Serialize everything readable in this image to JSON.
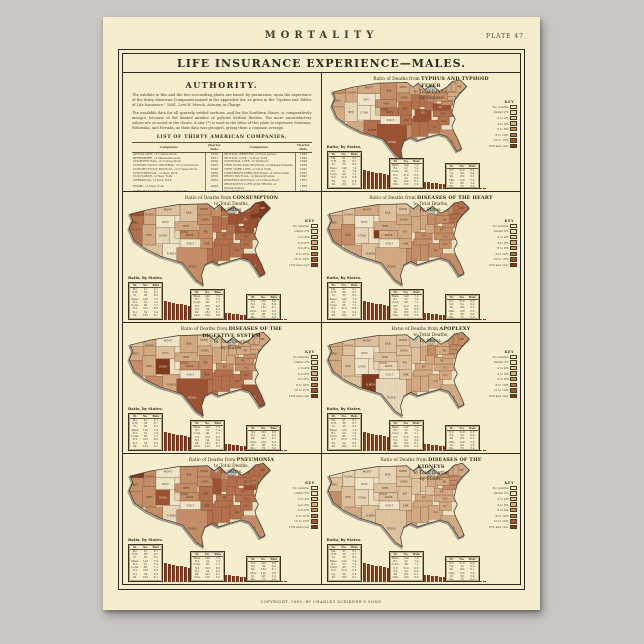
{
  "background_color": "#c9c6c4",
  "poster": {
    "bg": "#f4eecf"
  },
  "header": {
    "title": "MORTALITY",
    "plate": "PLATE 47"
  },
  "banner": {
    "title": "LIFE INSURANCE EXPERIENCE—MALES."
  },
  "authority": {
    "heading": "AUTHORITY.",
    "paragraphs": [
      "The exhibits in this and the two succeeding plates are based, by permission, upon the experience of the thirty American Companies named in the appended list, as given in the \"System and Tables of Life Insurance,\" 1881, Levi W. Meech, Actuary in Charge.",
      "The available data for all sparsely settled sections, and for the Southern States, is comparatively meagre, because of the limited number of policies written therein. The more unsatisfactory values are so noted in the charts. A star (*) is used in the titles of this plate to represent Montana, Nebraska, and Nevada, as their data was grouped, giving them a common average."
    ],
    "list_title": "LIST OF THIRTY AMERICAN COMPANIES.",
    "table_headers": [
      "Companies",
      "Charter Date",
      "Companies",
      "Charter Date"
    ],
    "companies_left": [
      [
        "AETNA LIFE, of Connecticut",
        "1850"
      ],
      [
        "BERKSHIRE, of Massachusetts",
        "1851"
      ],
      [
        "CHARTER OAK, of Connecticut",
        "1850"
      ],
      [
        "CONNECTICUT GENERAL, of Connecticut",
        "1865"
      ],
      [
        "CONNECTICUT MUTUAL, of Connecticut",
        "1846"
      ],
      [
        "CONTINENTAL, of New York",
        "1866"
      ],
      [
        "EQUITABLE, of New York",
        "1859"
      ],
      [
        "GERMANIA, of New York",
        "1860"
      ],
      [
        "HOME, of New York",
        "1860"
      ],
      [
        "JOHN HANCOCK, of Massachusetts",
        "1862"
      ],
      [
        "LIFE ASSOCIATION, of Missouri",
        "1868"
      ],
      [
        "MANHATTAN, of New York",
        "1850"
      ],
      [
        "MASSACHUSETTS HOSPITAL, of Massachusetts",
        "1823"
      ],
      [
        "MASSACHUSETTS MUTUAL, of Massachusetts",
        "1851"
      ],
      [
        "METROPOLITAN, of New York",
        "1866"
      ]
    ],
    "companies_right": [
      [
        "MUTUAL BENEFIT, of New Jersey",
        "1845"
      ],
      [
        "MUTUAL LIFE, of New York",
        "1842"
      ],
      [
        "NATIONAL LIFE, of Vermont",
        "1848"
      ],
      [
        "NEW ENGLAND MUTUAL, of Massachusetts",
        "1835"
      ],
      [
        "NEW YORK LIFE, of New York",
        "1841"
      ],
      [
        "NORTHWESTERN MUTUAL, of Wisconsin",
        "1857"
      ],
      [
        "PENN MUTUAL, of Pennsylvania",
        "1847"
      ],
      [
        "PHOENIX MUTUAL, of Connecticut",
        "1851"
      ],
      [
        "PROVIDENT LIFE AND TRUST, of Pennsylvania",
        "1865"
      ],
      [
        "ST. LOUIS MUTUAL, of Missouri",
        "1857"
      ],
      [
        "TRAVELERS, of Connecticut",
        "1863"
      ],
      [
        "UNION CENTRAL, of Ohio",
        "1867"
      ],
      [
        "UNION MUTUAL, of Maine",
        "1848"
      ],
      [
        "UNITED STATES, of New York",
        "1850"
      ],
      [
        "WASHINGTON, of New York",
        "1860"
      ]
    ]
  },
  "footer": {
    "caption": "COPYRIGHT, 1883, BY CHARLES SCRIBNER'S SONS."
  },
  "palette": [
    "#f2ebcf",
    "#eadbbc",
    "#e0c6a2",
    "#d4ad87",
    "#c5906a",
    "#b4724f",
    "#9d5334",
    "#7f3a1d"
  ],
  "key": {
    "header": "KEY",
    "labels": [
      "No returns",
      "Under 2%",
      "2 to 4%",
      "4 to 6%",
      "6 to 8%",
      "8 to 10%",
      "10 to 15%",
      "15% and over"
    ]
  },
  "map_title": {
    "prefix": "Ratio of Deaths from",
    "mid": "to Total Deaths,",
    "suffix": "by States."
  },
  "legend_label": "Ratio, by States.",
  "mini_table": {
    "headers": [
      "St.",
      "No.",
      "Rate"
    ],
    "rows": [
      [
        "Me.",
        "41",
        "9.1"
      ],
      [
        "N.H.",
        "38",
        "8.7"
      ],
      [
        "Vt.",
        "36",
        "8.2"
      ],
      [
        "Mass.",
        "140",
        "7.9"
      ],
      [
        "R.I.",
        "22",
        "7.4"
      ],
      [
        "Conn.",
        "96",
        "7.1"
      ],
      [
        "N.Y.",
        "310",
        "6.8"
      ],
      [
        "N.J.",
        "54",
        "6.4"
      ],
      [
        "Pa.",
        "182",
        "6.1"
      ],
      [
        "Ohio",
        "120",
        "5.8"
      ],
      [
        "Ill.",
        "98",
        "5.4"
      ],
      [
        "Mo.",
        "72",
        "5.0"
      ]
    ]
  },
  "legend_bars": [
    16.2,
    15.1,
    14.2,
    13.4,
    12.7,
    12.0,
    11.4,
    10.8,
    10.2,
    9.7,
    9.2,
    8.7,
    8.2,
    7.8,
    7.3,
    6.9,
    6.5,
    6.1,
    5.7,
    5.4,
    5.0,
    4.7,
    4.3,
    4.0,
    3.7,
    3.4,
    3.1,
    2.8,
    2.6,
    2.3,
    2.1,
    1.8,
    1.6,
    1.4,
    1.2,
    1.0,
    0.8,
    0.7,
    0.5,
    0.4
  ],
  "map_outline": "M6,16 L30,10 L62,5 L96,4 L104,10 L110,5 L118,13 L126,7 L136,15 L146,9 L152,3 L161,1 L169,9 L161,17 L155,25 L153,33 L151,41 L155,49 L151,57 L153,63 L159,75 L163,85 L157,88 L151,78 L145,70 L135,67 L121,71 L109,75 L101,71 L93,75 L89,87 L91,98 L83,93 L75,83 L67,73 L55,69 L41,65 L25,57 L11,47 L5,33 L9,23 Z",
  "lakes": [
    [
      106,
      7,
      2.5,
      5
    ],
    [
      124,
      12,
      6,
      3
    ],
    [
      115,
      4,
      6,
      2.5
    ]
  ],
  "states": [
    {
      "abbr": "WASH",
      "x": 2,
      "y": 5,
      "w": 20,
      "h": 13
    },
    {
      "abbr": "OREG",
      "x": 0,
      "y": 18,
      "w": 22,
      "h": 16
    },
    {
      "abbr": "CAL",
      "x": 0,
      "y": 34,
      "w": 20,
      "h": 34
    },
    {
      "abbr": "NEV",
      "x": 20,
      "y": 28,
      "w": 16,
      "h": 24
    },
    {
      "abbr": "IDAHO",
      "x": 22,
      "y": 5,
      "w": 14,
      "h": 23
    },
    {
      "abbr": "MONT",
      "x": 36,
      "y": 3,
      "w": 28,
      "h": 15
    },
    {
      "abbr": "WYO",
      "x": 36,
      "y": 18,
      "w": 22,
      "h": 14
    },
    {
      "abbr": "UTAH",
      "x": 36,
      "y": 32,
      "w": 16,
      "h": 18
    },
    {
      "abbr": "ARIZ",
      "x": 24,
      "y": 52,
      "w": 20,
      "h": 22
    },
    {
      "abbr": "COLO",
      "x": 58,
      "y": 30,
      "w": 22,
      "h": 14
    },
    {
      "abbr": "N.MEX",
      "x": 44,
      "y": 50,
      "w": 20,
      "h": 24
    },
    {
      "abbr": "DAK",
      "x": 64,
      "y": 3,
      "w": 20,
      "h": 22
    },
    {
      "abbr": "NEB",
      "x": 58,
      "y": 25,
      "w": 26,
      "h": 10
    },
    {
      "abbr": "KANS",
      "x": 64,
      "y": 35,
      "w": 22,
      "h": 10
    },
    {
      "abbr": "IND.T",
      "x": 64,
      "y": 45,
      "w": 24,
      "h": 10
    },
    {
      "abbr": "TEXAS",
      "x": 60,
      "y": 55,
      "w": 36,
      "h": 44
    },
    {
      "abbr": "MINN",
      "x": 84,
      "y": 3,
      "w": 16,
      "h": 14
    },
    {
      "abbr": "IOWA",
      "x": 84,
      "y": 17,
      "w": 18,
      "h": 11
    },
    {
      "abbr": "MO",
      "x": 86,
      "y": 28,
      "w": 16,
      "h": 16
    },
    {
      "abbr": "ARK",
      "x": 88,
      "y": 44,
      "w": 14,
      "h": 12
    },
    {
      "abbr": "LA",
      "x": 96,
      "y": 56,
      "w": 12,
      "h": 20
    },
    {
      "abbr": "WIS",
      "x": 100,
      "y": 4,
      "w": 12,
      "h": 15
    },
    {
      "abbr": "ILL",
      "x": 102,
      "y": 19,
      "w": 10,
      "h": 18
    },
    {
      "abbr": "MISS",
      "x": 102,
      "y": 48,
      "w": 10,
      "h": 22
    },
    {
      "abbr": "MICH",
      "x": 112,
      "y": 2,
      "w": 16,
      "h": 16
    },
    {
      "abbr": "IND",
      "x": 112,
      "y": 19,
      "w": 8,
      "h": 15
    },
    {
      "abbr": "OHIO",
      "x": 120,
      "y": 16,
      "w": 12,
      "h": 14
    },
    {
      "abbr": "KY",
      "x": 106,
      "y": 37,
      "w": 20,
      "h": 8
    },
    {
      "abbr": "TENN",
      "x": 104,
      "y": 45,
      "w": 22,
      "h": 7
    },
    {
      "abbr": "ALA",
      "x": 112,
      "y": 52,
      "w": 10,
      "h": 18
    },
    {
      "abbr": "GA",
      "x": 122,
      "y": 50,
      "w": 16,
      "h": 16
    },
    {
      "abbr": "FLA",
      "x": 136,
      "y": 62,
      "w": 26,
      "h": 28
    },
    {
      "abbr": "S.C",
      "x": 134,
      "y": 46,
      "w": 14,
      "h": 10
    },
    {
      "abbr": "N.C",
      "x": 128,
      "y": 38,
      "w": 26,
      "h": 8
    },
    {
      "abbr": "VA",
      "x": 124,
      "y": 30,
      "w": 26,
      "h": 8
    },
    {
      "abbr": "W.VA",
      "x": 118,
      "y": 28,
      "w": 10,
      "h": 10
    },
    {
      "abbr": "PA",
      "x": 130,
      "y": 18,
      "w": 20,
      "h": 9
    },
    {
      "abbr": "N.Y",
      "x": 132,
      "y": 5,
      "w": 20,
      "h": 13
    },
    {
      "abbr": "N.J",
      "x": 150,
      "y": 22,
      "w": 6,
      "h": 9
    },
    {
      "abbr": "MD",
      "x": 138,
      "y": 27,
      "w": 14,
      "h": 5
    },
    {
      "abbr": "ME",
      "x": 152,
      "y": 0,
      "w": 16,
      "h": 18
    },
    {
      "abbr": "N.H",
      "x": 150,
      "y": 4,
      "w": 6,
      "h": 11
    },
    {
      "abbr": "VT",
      "x": 145,
      "y": 5,
      "w": 5,
      "h": 10
    },
    {
      "abbr": "MASS",
      "x": 146,
      "y": 16,
      "w": 14,
      "h": 5
    },
    {
      "abbr": "CONN",
      "x": 146,
      "y": 21,
      "w": 9,
      "h": 5
    },
    {
      "abbr": "R.I",
      "x": 160,
      "y": 18,
      "w": 4,
      "h": 4
    }
  ],
  "maps": [
    {
      "id": "typhoid",
      "disease": "TYPHUS AND TYPHOID FEVER",
      "shades": [
        4,
        3,
        3,
        1,
        3,
        3,
        0,
        0,
        3,
        2,
        5,
        4,
        4,
        5,
        0,
        6,
        3,
        4,
        5,
        5,
        4,
        3,
        5,
        5,
        3,
        5,
        4,
        6,
        6,
        5,
        5,
        4,
        5,
        5,
        6,
        5,
        4,
        3,
        3,
        4,
        3,
        3,
        3,
        3,
        3,
        3
      ]
    },
    {
      "id": "consumption",
      "disease": "CONSUMPTION",
      "shades": [
        6,
        5,
        5,
        3,
        3,
        2,
        0,
        1,
        2,
        1,
        0,
        2,
        3,
        4,
        0,
        4,
        4,
        4,
        4,
        4,
        5,
        4,
        5,
        5,
        5,
        5,
        6,
        5,
        5,
        5,
        5,
        6,
        5,
        5,
        6,
        5,
        6,
        6,
        6,
        6,
        7,
        6,
        6,
        7,
        6,
        6
      ]
    },
    {
      "id": "heart",
      "disease": "DISEASES OF THE HEART",
      "shades": [
        2,
        3,
        4,
        4,
        2,
        3,
        0,
        1,
        3,
        7,
        2,
        2,
        3,
        3,
        0,
        3,
        2,
        3,
        3,
        3,
        4,
        3,
        3,
        4,
        3,
        3,
        4,
        4,
        4,
        4,
        4,
        4,
        4,
        4,
        4,
        3,
        4,
        4,
        4,
        4,
        5,
        5,
        4,
        5,
        5,
        5
      ]
    },
    {
      "id": "digestive",
      "disease": "DISEASES OF THE DIGESTIVE SYSTEM",
      "shades": [
        2,
        3,
        4,
        3,
        3,
        0,
        2,
        7,
        4,
        0,
        3,
        3,
        3,
        4,
        0,
        6,
        2,
        3,
        4,
        5,
        5,
        2,
        3,
        5,
        2,
        3,
        3,
        4,
        5,
        5,
        5,
        6,
        5,
        4,
        4,
        3,
        3,
        3,
        3,
        4,
        3,
        3,
        3,
        3,
        3,
        3
      ]
    },
    {
      "id": "apoplexy",
      "disease": "APOPLEXY",
      "shades": [
        3,
        3,
        3,
        2,
        2,
        2,
        0,
        0,
        2,
        1,
        7,
        2,
        2,
        1,
        0,
        1,
        2,
        2,
        2,
        2,
        3,
        2,
        2,
        3,
        2,
        3,
        4,
        3,
        3,
        3,
        3,
        3,
        3,
        3,
        3,
        3,
        3,
        3,
        3,
        3,
        4,
        4,
        4,
        4,
        4,
        4
      ]
    },
    {
      "id": "pneumonia",
      "disease": "PNEUMONIA",
      "shades": [
        7,
        4,
        4,
        4,
        4,
        0,
        0,
        6,
        4,
        1,
        1,
        4,
        4,
        4,
        0,
        4,
        4,
        4,
        5,
        5,
        5,
        5,
        6,
        5,
        4,
        5,
        5,
        5,
        5,
        5,
        5,
        4,
        5,
        5,
        5,
        5,
        5,
        5,
        5,
        6,
        5,
        5,
        5,
        5,
        5,
        5
      ]
    },
    {
      "id": "kidneys",
      "disease": "DISEASES OF THE KIDNEYS",
      "shades": [
        1,
        2,
        4,
        2,
        1,
        1,
        0,
        1,
        3,
        1,
        2,
        1,
        2,
        2,
        0,
        2,
        2,
        2,
        2,
        2,
        3,
        2,
        2,
        3,
        2,
        2,
        3,
        3,
        3,
        3,
        3,
        3,
        3,
        3,
        3,
        2,
        3,
        4,
        4,
        4,
        3,
        3,
        3,
        4,
        4,
        4
      ]
    }
  ]
}
